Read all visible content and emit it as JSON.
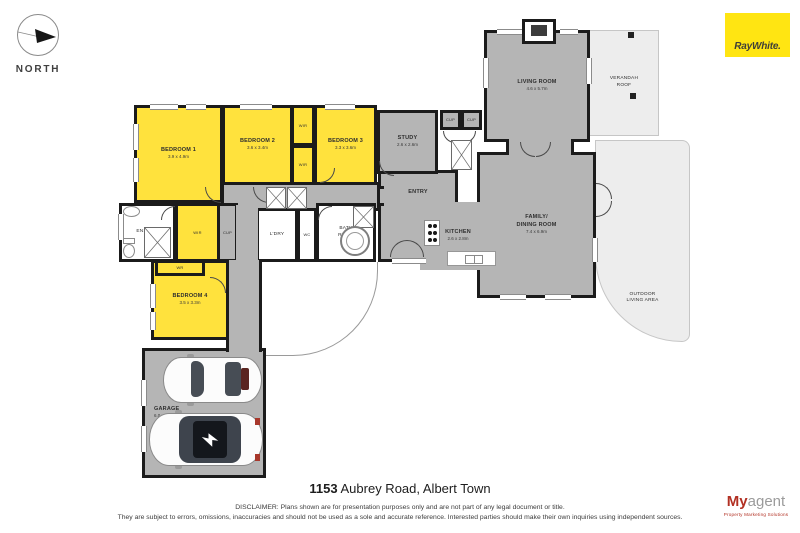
{
  "header": {
    "north_label": "NORTH",
    "brand": "RayWhite.",
    "brand_bg": "#ffe512"
  },
  "floorplan": {
    "wall_color": "#1b1b1b",
    "room_yellow": "#ffe23d",
    "room_gray": "#b5b5b5",
    "room_light": "#ededed",
    "rooms": [
      {
        "id": "verandah-roof",
        "label": "VERANDAH ROOF",
        "x": 589,
        "y": 30,
        "w": 70,
        "h": 106,
        "fill": "#ededed",
        "bw": "1px",
        "bc": "#c6c6c6",
        "cls": "small w30"
      },
      {
        "id": "outdoor-living-area",
        "label": "OUTDOOR LIVING AREA",
        "x": 595,
        "y": 140,
        "w": 95,
        "h": 202,
        "fill": "#ededed",
        "bw": "1px",
        "bc": "#c6c6c6",
        "radius": "0 10px 10px 110px",
        "cls": "small w42 low"
      },
      {
        "id": "rear-porch",
        "x": 263,
        "y": 262,
        "w": 115,
        "h": 94,
        "fill": "#ffffff",
        "bw": "0 1px 1px 0",
        "bc": "#9a9a9a",
        "radius": "0 0 85px 0"
      },
      {
        "id": "living-room",
        "label": "LIVING ROOM",
        "dims": "4.6 x 5.7m",
        "x": 484,
        "y": 30,
        "w": 106,
        "h": 112,
        "fill": "#b5b5b5"
      },
      {
        "id": "family-dining-room",
        "label": "FAMILY/ DINING ROOM",
        "dims": "7.4 x 6.9m",
        "x": 477,
        "y": 152,
        "w": 119,
        "h": 146,
        "fill": "#b5b5b5",
        "cls": "w42"
      },
      {
        "id": "living-family-link",
        "x": 506,
        "y": 139,
        "w": 68,
        "h": 16,
        "fill": "#b5b5b5",
        "bw": "0 3px 0 3px"
      },
      {
        "id": "entry",
        "label": "ENTRY",
        "x": 378,
        "y": 170,
        "w": 80,
        "h": 92,
        "fill": "#b5b5b5",
        "cls": "high"
      },
      {
        "id": "hall-entry-link",
        "x": 374,
        "y": 186,
        "w": 10,
        "h": 20,
        "fill": "#b5b5b5",
        "bw": "3px 0 3px 0"
      },
      {
        "id": "kitchen",
        "label": "KITCHEN",
        "dims": "2.6 x 2.8m",
        "x": 420,
        "y": 202,
        "w": 76,
        "h": 68,
        "fill": "#b5b5b5",
        "bw": "0"
      },
      {
        "id": "study",
        "label": "STUDY",
        "dims": "2.6 x 2.6m",
        "x": 377,
        "y": 110,
        "w": 61,
        "h": 64,
        "fill": "#b5b5b5"
      },
      {
        "id": "cupboard-1",
        "label": "CUP",
        "x": 440,
        "y": 110,
        "w": 21,
        "h": 20,
        "fill": "#b5b5b5",
        "cls": "tiny"
      },
      {
        "id": "cupboard-2",
        "label": "CUP",
        "x": 461,
        "y": 110,
        "w": 21,
        "h": 20,
        "fill": "#b5b5b5",
        "cls": "tiny"
      },
      {
        "id": "hallway",
        "x": 221,
        "y": 182,
        "w": 159,
        "h": 29,
        "fill": "#b5b5b5"
      },
      {
        "id": "ensuite",
        "label": "ENSUITE",
        "x": 119,
        "y": 203,
        "w": 57,
        "h": 59,
        "fill": "#ffffff",
        "cls": "small"
      },
      {
        "id": "wir-master",
        "label": "WIR",
        "x": 175,
        "y": 203,
        "w": 45,
        "h": 59,
        "fill": "#ffe23d",
        "cls": "tiny"
      },
      {
        "id": "cupboard-hall",
        "label": "CUP",
        "x": 217,
        "y": 203,
        "w": 21,
        "h": 59,
        "fill": "#b5b5b5",
        "cls": "tiny"
      },
      {
        "id": "laundry",
        "label": "L'DRY",
        "x": 256,
        "y": 208,
        "w": 42,
        "h": 54,
        "fill": "#ffffff",
        "cls": "small"
      },
      {
        "id": "wc",
        "label": "WC",
        "x": 297,
        "y": 208,
        "w": 20,
        "h": 54,
        "fill": "#ffffff",
        "cls": "tiny"
      },
      {
        "id": "bathroom",
        "label": "BATH ROOM",
        "x": 316,
        "y": 203,
        "w": 60,
        "h": 59,
        "fill": "#ffffff",
        "cls": "small w16"
      },
      {
        "id": "passage",
        "x": 236,
        "y": 205,
        "w": 22,
        "h": 57,
        "fill": "#b5b5b5",
        "bw": "0"
      },
      {
        "id": "bedroom-4",
        "label": "BEDROOM 4",
        "dims": "3.5 x 3.3m",
        "x": 151,
        "y": 260,
        "w": 78,
        "h": 80,
        "fill": "#ffe23d"
      },
      {
        "id": "wardrobe-4",
        "label": "WR",
        "x": 155,
        "y": 260,
        "w": 50,
        "h": 16,
        "fill": "#ffe23d",
        "cls": "tiny"
      },
      {
        "id": "garage",
        "label": "GARAGE",
        "dims": "6.0 x 6.6m",
        "x": 142,
        "y": 348,
        "w": 124,
        "h": 130,
        "fill": "#b5b5b5",
        "cls": "lab-left"
      },
      {
        "id": "corridor",
        "x": 226,
        "y": 260,
        "w": 36,
        "h": 92,
        "fill": "#b5b5b5",
        "bw": "0 3px 0 3px"
      },
      {
        "id": "bedroom-1",
        "label": "BEDROOM 1",
        "dims": "3.9 x 4.9m",
        "x": 134,
        "y": 105,
        "w": 89,
        "h": 98,
        "fill": "#ffe23d"
      },
      {
        "id": "bedroom-2",
        "label": "BEDROOM 2",
        "dims": "3.6 x 3.4m",
        "x": 222,
        "y": 105,
        "w": 71,
        "h": 80,
        "fill": "#ffe23d"
      },
      {
        "id": "wir-2",
        "label": "WIR",
        "x": 291,
        "y": 105,
        "w": 24,
        "h": 41,
        "fill": "#ffe23d",
        "cls": "tiny"
      },
      {
        "id": "wir-3",
        "label": "WIR",
        "x": 291,
        "y": 145,
        "w": 24,
        "h": 40,
        "fill": "#ffe23d",
        "cls": "tiny"
      },
      {
        "id": "bedroom-3",
        "label": "BEDROOM 3",
        "dims": "3.3 x 3.6m",
        "x": 314,
        "y": 105,
        "w": 63,
        "h": 80,
        "fill": "#ffe23d"
      }
    ]
  },
  "footer": {
    "address_number": "1153",
    "address_rest": " Aubrey Road, Albert Town",
    "disclaimer_line1": "DISCLAIMER: Plans shown are for presentation purposes only and are not part of any legal document or title.",
    "disclaimer_line2": "They are subject to errors, omissions, inaccuracies and should not be used as a sole and accurate reference. Interested parties should make their own inquiries using independent sources.",
    "logo_my": "My",
    "logo_agent": "agent",
    "logo_tagline": "Property Marketing Solutions"
  }
}
